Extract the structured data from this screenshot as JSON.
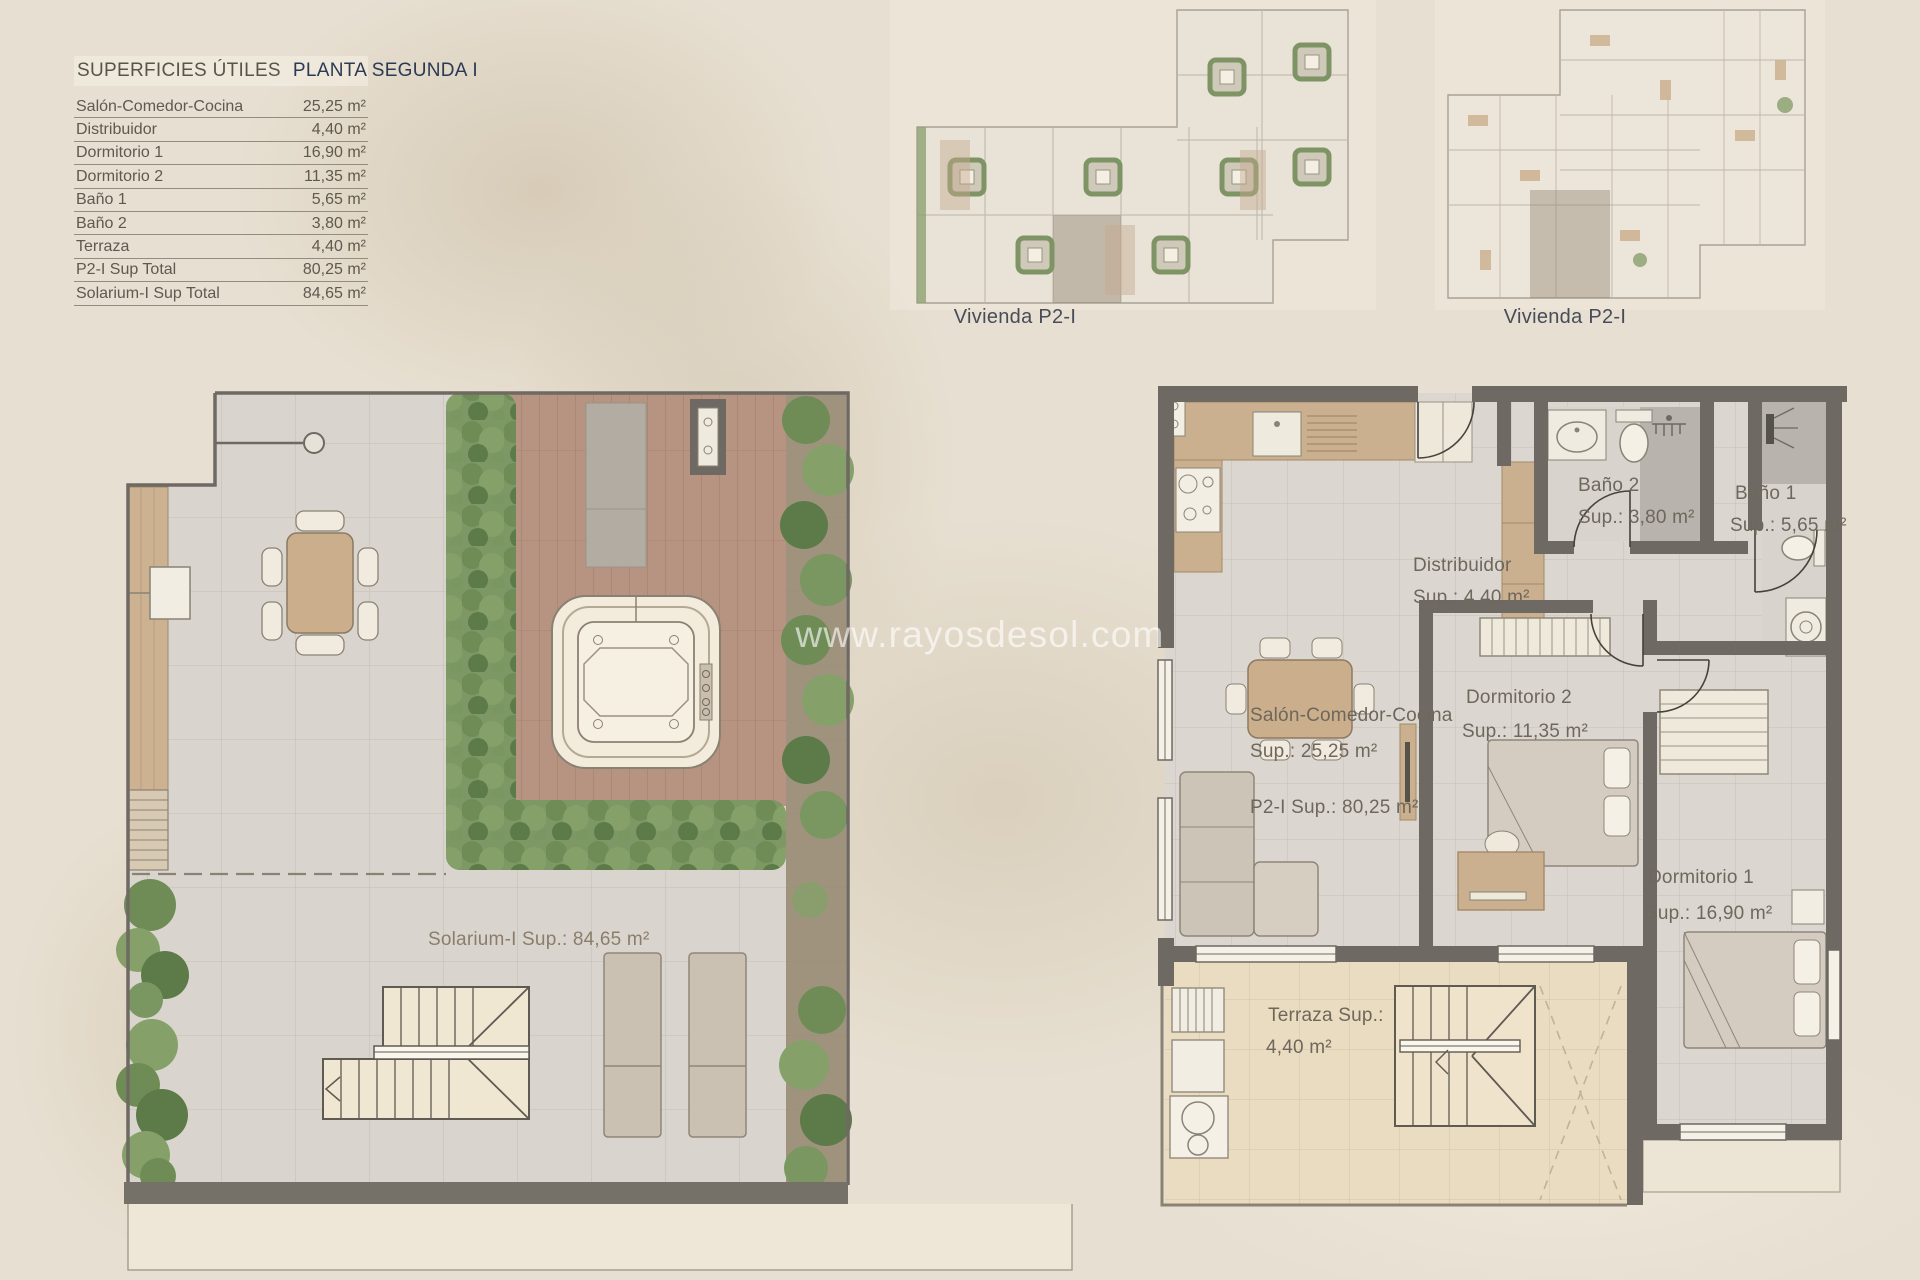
{
  "page": {
    "watermark": "www.rayosdesol.com"
  },
  "surface_table": {
    "title": "SUPERFICIES ÚTILES",
    "subtitle": "PLANTA SEGUNDA I",
    "rows": [
      {
        "label": "Salón-Comedor-Cocina",
        "value": "25,25 m²"
      },
      {
        "label": "Distribuidor",
        "value": "4,40 m²"
      },
      {
        "label": "Dormitorio 1",
        "value": "16,90 m²"
      },
      {
        "label": "Dormitorio 2",
        "value": "11,35 m²"
      },
      {
        "label": "Baño 1",
        "value": "5,65 m²"
      },
      {
        "label": "Baño 2",
        "value": "3,80 m²"
      },
      {
        "label": "Terraza",
        "value": "4,40 m²"
      },
      {
        "label": "P2-I Sup Total",
        "value": "80,25 m²"
      },
      {
        "label": "Solarium-I Sup Total",
        "value": "84,65 m²"
      }
    ]
  },
  "mini_plans": [
    {
      "caption": "Vivienda P2-I"
    },
    {
      "caption": "Vivienda P2-I"
    }
  ],
  "solarium_plan": {
    "area_label": "Solarium-I Sup.: 84,65 m²"
  },
  "apartment_plan": {
    "bano2": {
      "name": "Baño 2",
      "sup": "Sup.: 3,80 m²"
    },
    "bano1": {
      "name": "Baño 1",
      "sup": "Sup.: 5,65 m²"
    },
    "distribuidor": {
      "name": "Distribuidor",
      "sup": "Sup.: 4,40 m²"
    },
    "salon": {
      "name": "Salón-Comedor-Cocina",
      "sup": "Sup.: 25,25 m²",
      "total": "P2-I Sup.: 80,25 m²"
    },
    "dormitorio2": {
      "name": "Dormitorio 2",
      "sup": "Sup.: 11,35 m²"
    },
    "dormitorio1": {
      "name": "Dormitorio 1",
      "sup": "Sup.: 16,90 m²"
    },
    "terraza": {
      "name": "Terraza Sup.:",
      "sup": "4,40 m²"
    }
  },
  "colors": {
    "background": "#e7dfd1",
    "wall": "#6e6963",
    "wood": "#cbb090",
    "deck": "#b69481",
    "greenery": "#7d9765",
    "tile_gray": "#d9d5ce",
    "tile_beige": "#e8dabc",
    "accent_title": "#2b3a52",
    "text": "#5f594e"
  }
}
